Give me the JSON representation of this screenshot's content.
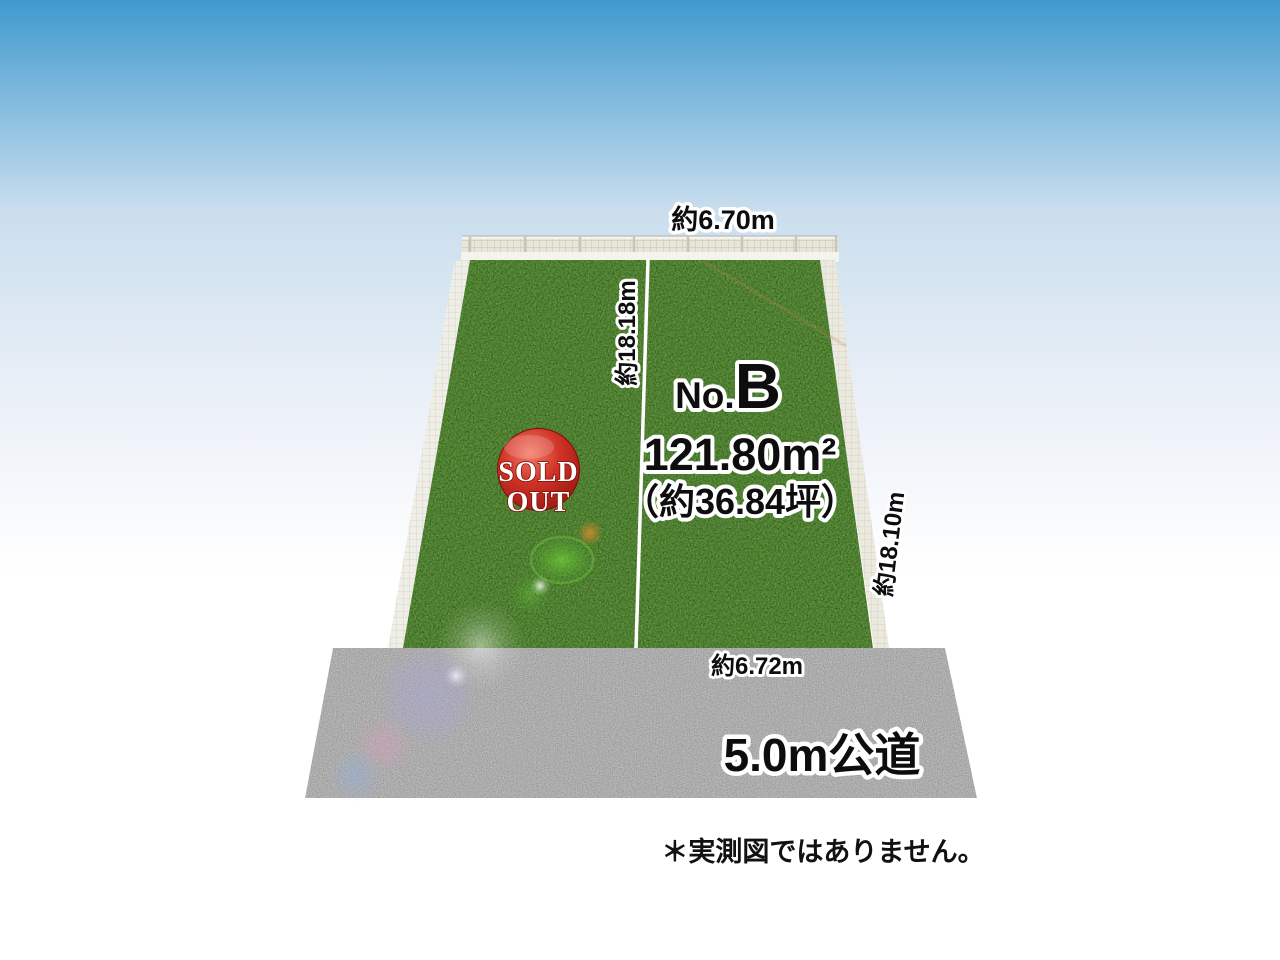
{
  "diagram": {
    "labels": {
      "top_width": "約6.70m",
      "left_depth": "約18.18m",
      "right_depth": "約18.10m",
      "bottom_width": "約6.72m",
      "road": "5.0m公道",
      "disclaimer": "＊実測図ではありません。"
    },
    "plot_b": {
      "no_prefix": "No.",
      "no_letter": "B",
      "area_sqm": "121.80m²",
      "area_tsubo": "（約36.84坪）"
    },
    "sold_out": {
      "line1": "SOLD",
      "line2": "OUT"
    },
    "colors": {
      "sky_top": "#3f9ace",
      "grass": "#457d27",
      "road": "#a6a6a6",
      "badge_red": "#d03326",
      "fence": "#e8e5d9",
      "divider": "#ffffff"
    }
  }
}
